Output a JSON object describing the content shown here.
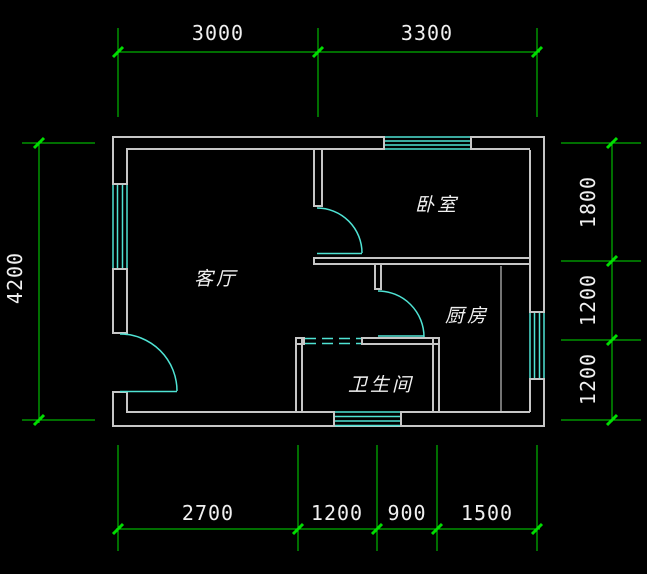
{
  "drawing": {
    "type": "architectural-floor-plan",
    "rooms": [
      {
        "id": "living-room",
        "label": "客厅"
      },
      {
        "id": "bedroom",
        "label": "卧室"
      },
      {
        "id": "kitchen",
        "label": "厨房"
      },
      {
        "id": "bathroom",
        "label": "卫生间"
      }
    ],
    "dimensions": {
      "top": [
        "3000",
        "3300"
      ],
      "left": [
        "4200"
      ],
      "right": [
        "1800",
        "1200",
        "1200"
      ],
      "bottom": [
        "2700",
        "1200",
        "900",
        "1500"
      ]
    },
    "fixtures": {
      "windows": [
        "top-wall-window",
        "left-wall-window",
        "right-wall-window",
        "bottom-wall-window"
      ],
      "doors": [
        "entrance-swing-door",
        "bedroom-swing-door",
        "kitchen-swing-door",
        "bathroom-sliding-door"
      ]
    },
    "colors": {
      "background": "#000000",
      "walls": "#C6C6C6",
      "dimension_lines": "#00DD00",
      "dimension_text": "#F0F0F0",
      "doors_windows": "#4FE3D4",
      "room_text": "#F0F0F0"
    }
  }
}
